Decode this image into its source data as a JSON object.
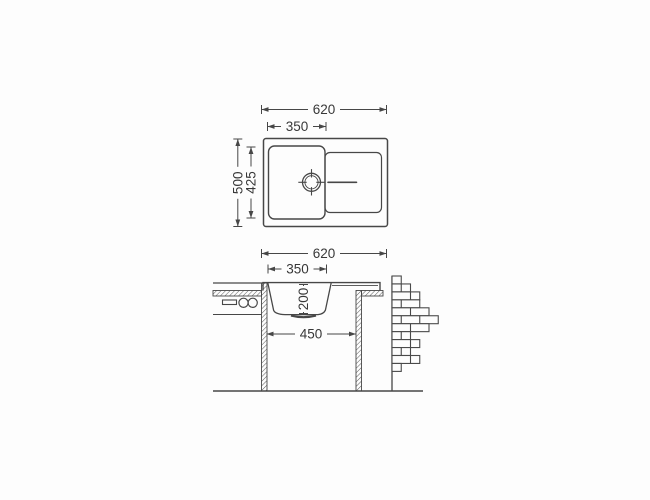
{
  "canvas": {
    "background": "#fdfdfd",
    "line_color": "#474747",
    "text_color": "#383838"
  },
  "drawing": {
    "dims": {
      "top_width": "620",
      "top_bowl_width": "350",
      "top_depth": "500",
      "top_bowl_depth": "425",
      "sec_width": "620",
      "sec_bowl_width": "350",
      "sec_bowl_depth": "200",
      "sec_cabinet_width": "450"
    }
  }
}
